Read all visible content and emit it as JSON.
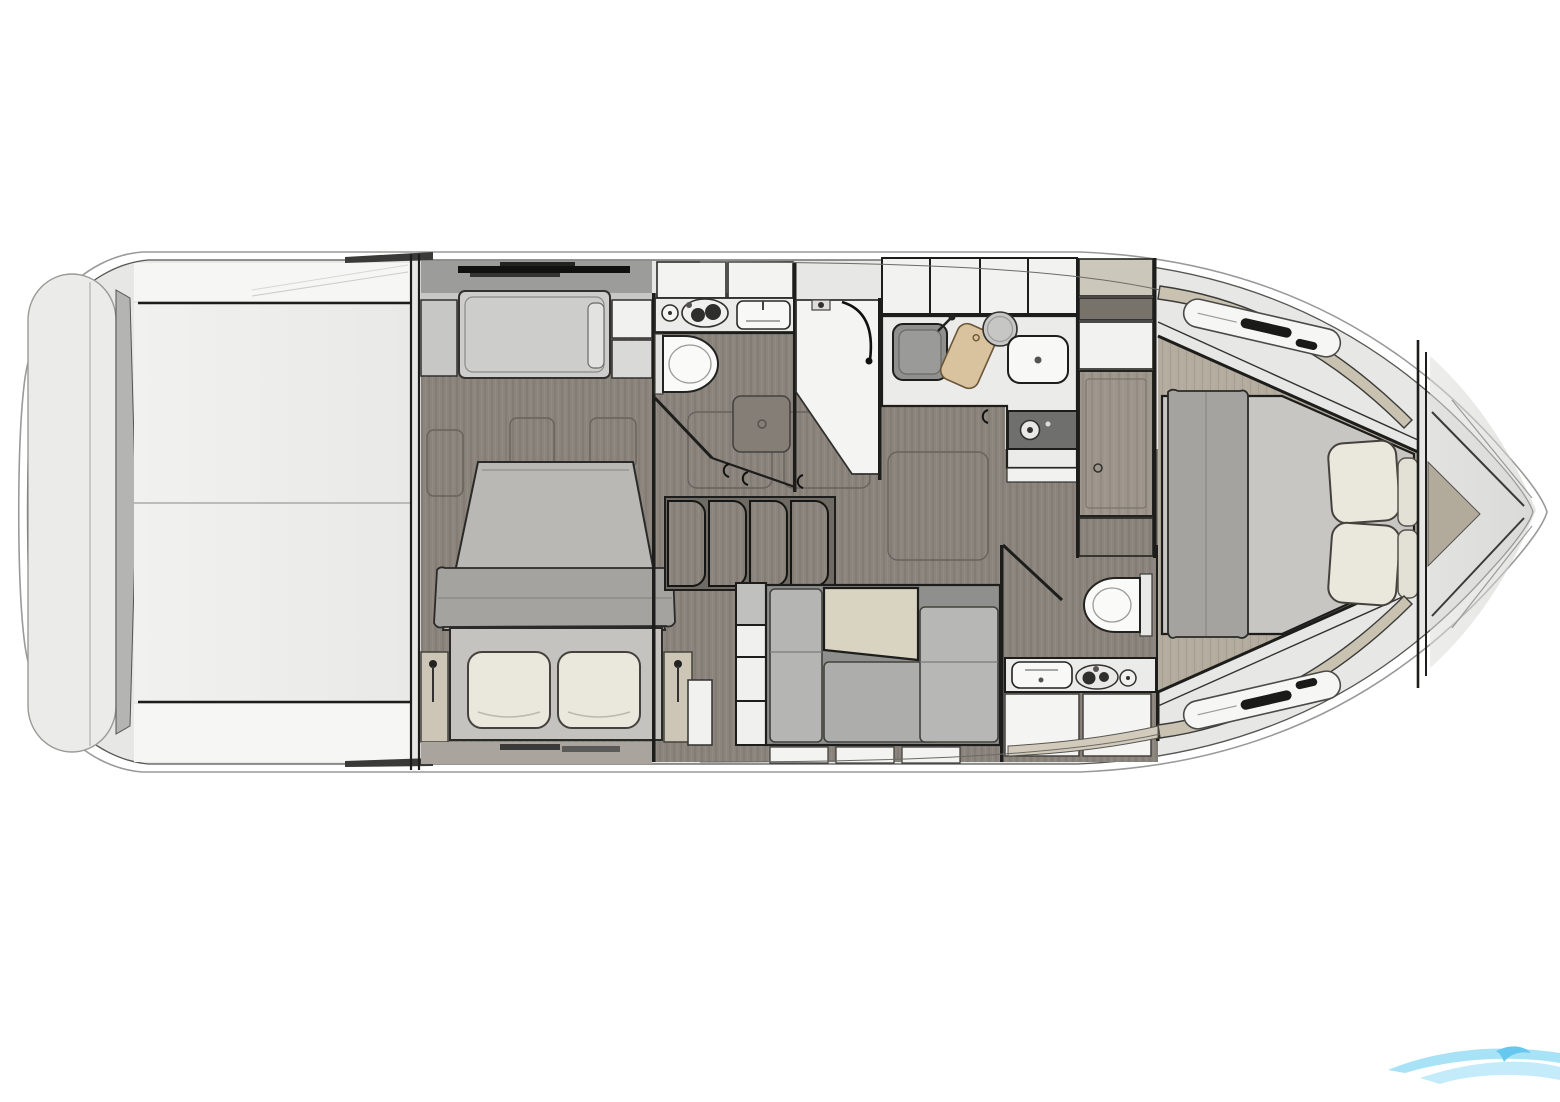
{
  "meta": {
    "title": "Motor yacht lower deck floor plan",
    "type": "floor-plan-top-view"
  },
  "palette": {
    "bg": "#ffffff",
    "line-strong": "#1d1d1b",
    "line-mid": "#555553",
    "line-soft": "#9a9a98",
    "deck": "#e7e7e5",
    "deck-band": "#c9c2b1",
    "platform": "#ebebe9",
    "cockpit": "#efefed",
    "wedge": "#b4b4b2",
    "wood": "#8a847c",
    "wood-stripe": "#7c766e",
    "wood-light": "#b3ab9d",
    "wood-light-stripe": "#a79f91",
    "walkway": "#9c9c9a",
    "cushion": "#cdcdcb",
    "cushion-dark": "#adadab",
    "sofa-base": "#8f8f8d",
    "pillow": "#eae7dc",
    "blanket": "#a4a3a0",
    "mattress": "#b9b8b5",
    "bed-base": "#c4c3c0",
    "master-bed": "#c7c6c3",
    "table-tan": "#d9d3c1",
    "board-tan": "#d9c29e",
    "counter": "#ebebe9",
    "fixture-white": "#f8f8f6",
    "appliance-dark": "#6f6f6d",
    "sink-dark": "#8f8f8d",
    "stair-well": "#6f6a63",
    "logo-blue-light": "#bde9f9",
    "logo-blue": "#9fdff6",
    "logo-blue-deep": "#57c3ee"
  },
  "areas": [
    {
      "id": "swim-platform",
      "label": "Swim platform (stern)"
    },
    {
      "id": "cockpit",
      "label": "Cockpit / aft deck, unfurnished"
    },
    {
      "id": "guest-cabin",
      "label": "Mid guest cabin with double bed, two pillows, sofa berth and side tables"
    },
    {
      "id": "guest-bathroom",
      "label": "Guest bathroom with vanity, toilet and shower floor"
    },
    {
      "id": "shower-stall",
      "label": "Separate shower stall with hand shower rail"
    },
    {
      "id": "stairs",
      "label": "Companionway stairs from salon"
    },
    {
      "id": "galley",
      "label": "L-shaped galley with sink, cutting board, bowl and cooktop"
    },
    {
      "id": "dinette",
      "label": "Salon dinette with L-sofa and table"
    },
    {
      "id": "day-head",
      "label": "Second bathroom with toilet and vanity"
    },
    {
      "id": "wardrobe",
      "label": "Wardrobe / door to forward cabin"
    },
    {
      "id": "master-cabin",
      "label": "Forward master cabin with island bed, blanket and four pillows"
    },
    {
      "id": "bow-deck",
      "label": "Bow deck with anchor locker chevrons"
    },
    {
      "id": "watermark",
      "label": "Light blue wave watermark, bottom right, partially cropped"
    }
  ],
  "icons": [
    {
      "name": "toilet-icon"
    },
    {
      "name": "sink-icon"
    },
    {
      "name": "cooktop-burner-icon"
    },
    {
      "name": "faucet-icon"
    },
    {
      "name": "cutting-board-icon"
    },
    {
      "name": "shower-drain-icon"
    },
    {
      "name": "door-handle-icon"
    },
    {
      "name": "lamp-icon"
    },
    {
      "name": "wave-logo-icon"
    }
  ]
}
